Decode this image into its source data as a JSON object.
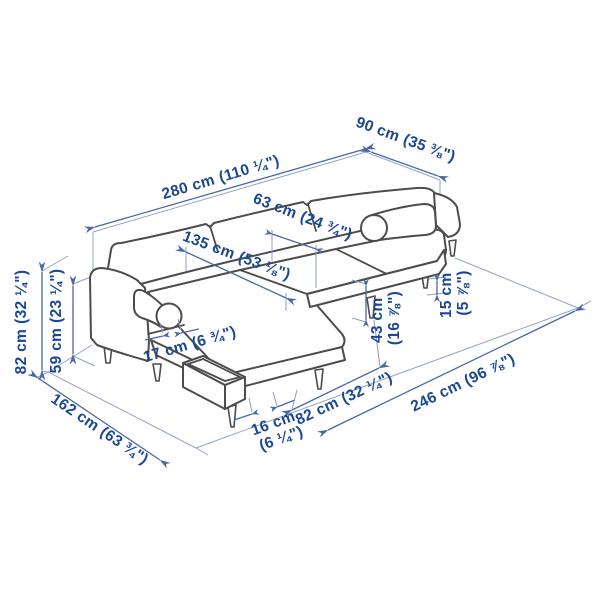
{
  "illustration": "sofa-with-chaise-longue-line-drawing",
  "colors": {
    "text": "#1a4894",
    "dimension_line": "#4a67a8",
    "guide_line": "#93a3c8",
    "artwork_outline": "#4c4c4c",
    "background": "#ffffff"
  },
  "dims": {
    "total_width": {
      "metric": "280 cm",
      "imperial": "(110 ¼\")"
    },
    "total_depth": {
      "metric": "90 cm",
      "imperial": "(35 ⅜\")"
    },
    "seat_cushion": {
      "metric": "63 cm",
      "imperial": "(24 ¾\")"
    },
    "chaise_length": {
      "metric": "135 cm",
      "imperial": "(53 ⅛\")"
    },
    "total_height": {
      "metric": "82 cm",
      "imperial": "(32 ¼\")"
    },
    "armrest_height": {
      "metric": "59 cm",
      "imperial": "(23 ¼\")"
    },
    "armrest_width": {
      "metric": "17 cm",
      "imperial": "(6 ¾\")"
    },
    "depth_with_chaise": {
      "metric": "162 cm",
      "imperial": "(63 ¾\")"
    },
    "leg_inset": {
      "metric": "16 cm",
      "imperial": "(6 ¼\")"
    },
    "seat_front_width": {
      "metric": "82 cm",
      "imperial": "(32 ¼\")"
    },
    "seat_height": {
      "metric": "43 cm",
      "imperial": "(16 ⅞\")"
    },
    "leg_height": {
      "metric": "15 cm",
      "imperial": "(5 ⅞\")"
    },
    "base_length": {
      "metric": "246 cm",
      "imperial": "(96 ⅞\")"
    }
  }
}
